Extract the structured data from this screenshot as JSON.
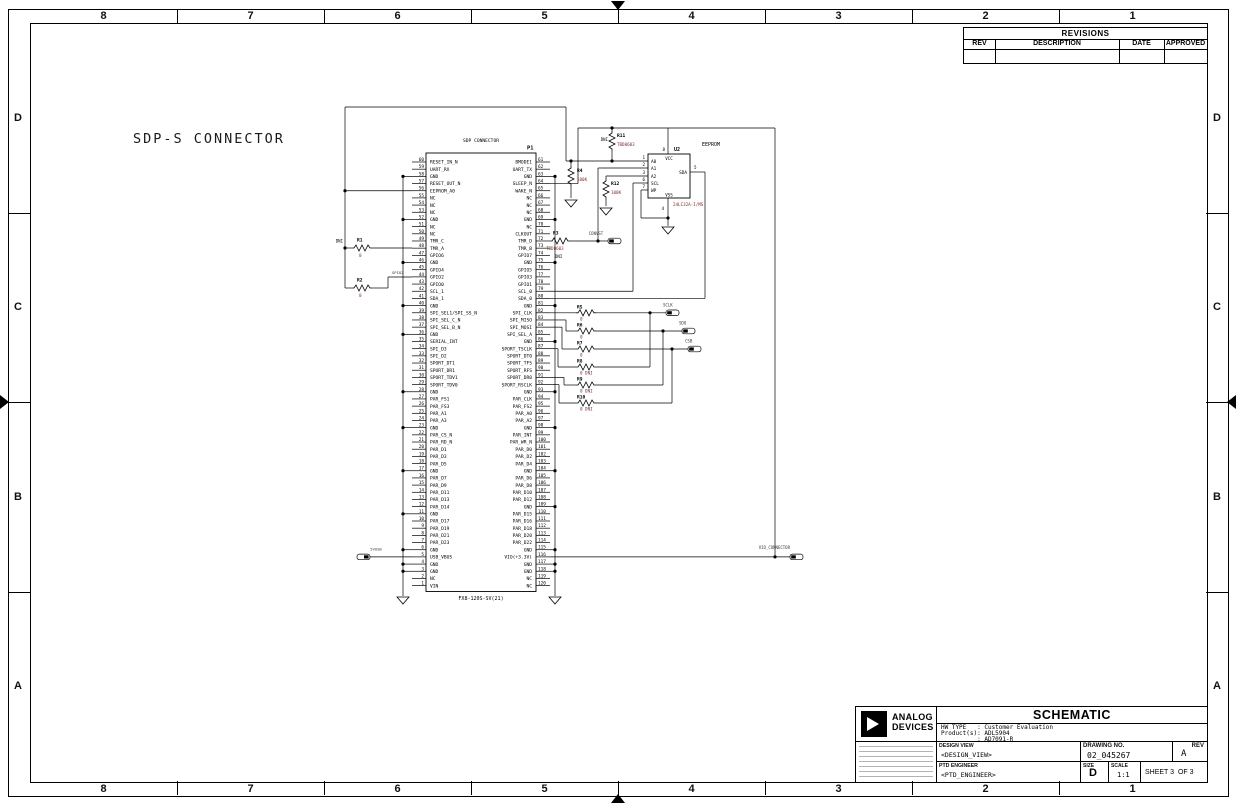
{
  "frame": {
    "columns": [
      "8",
      "7",
      "6",
      "5",
      "4",
      "3",
      "2",
      "1"
    ],
    "rows": [
      "D",
      "C",
      "B",
      "A"
    ]
  },
  "heading": "SDP-S CONNECTOR",
  "revisions": {
    "title": "REVISIONS",
    "headers": [
      "REV",
      "DESCRIPTION",
      "DATE",
      "APPROVED"
    ]
  },
  "connector": {
    "title": "SDP CONNECTOR",
    "refdes": "P1",
    "part": "FX8-120S-SV(21)",
    "left_pins": [
      [
        60,
        "RESET_IN_N"
      ],
      [
        59,
        "UART_RX"
      ],
      [
        58,
        "GND"
      ],
      [
        57,
        "RESET_OUT_N"
      ],
      [
        56,
        "EEPROM_A0"
      ],
      [
        55,
        "NC"
      ],
      [
        54,
        "NC"
      ],
      [
        53,
        "NC"
      ],
      [
        52,
        "GND"
      ],
      [
        51,
        "NC"
      ],
      [
        50,
        "NC"
      ],
      [
        49,
        "TMR_C"
      ],
      [
        48,
        "TMR_A"
      ],
      [
        47,
        "GPIO6"
      ],
      [
        46,
        "GND"
      ],
      [
        45,
        "GPIO4"
      ],
      [
        44,
        "GPIO2"
      ],
      [
        43,
        "GPIO0"
      ],
      [
        42,
        "SCL_1"
      ],
      [
        41,
        "SDA_1"
      ],
      [
        40,
        "GND"
      ],
      [
        39,
        "SPI_SEL1/SPI_SS_N"
      ],
      [
        38,
        "SPI_SEL_C_N"
      ],
      [
        37,
        "SPI_SEL_B_N"
      ],
      [
        36,
        "GND"
      ],
      [
        35,
        "SERIAL_INT"
      ],
      [
        34,
        "SPI_D3"
      ],
      [
        33,
        "SPI_D2"
      ],
      [
        32,
        "SPORT_DT1"
      ],
      [
        31,
        "SPORT_DR1"
      ],
      [
        30,
        "SPORT_TDV1"
      ],
      [
        29,
        "SPORT_TDV0"
      ],
      [
        28,
        "GND"
      ],
      [
        27,
        "PAR_FS1"
      ],
      [
        26,
        "PAR_FS3"
      ],
      [
        25,
        "PAR_A1"
      ],
      [
        24,
        "PAR_A3"
      ],
      [
        23,
        "GND"
      ],
      [
        22,
        "PAR_CS_N"
      ],
      [
        21,
        "PAR_RD_N"
      ],
      [
        20,
        "PAR_D1"
      ],
      [
        19,
        "PAR_D3"
      ],
      [
        18,
        "PAR_D5"
      ],
      [
        17,
        "GND"
      ],
      [
        16,
        "PAR_D7"
      ],
      [
        15,
        "PAR_D9"
      ],
      [
        14,
        "PAR_D11"
      ],
      [
        13,
        "PAR_D13"
      ],
      [
        12,
        "PAR_D14"
      ],
      [
        11,
        "GND"
      ],
      [
        10,
        "PAR_D17"
      ],
      [
        9,
        "PAR_D19"
      ],
      [
        8,
        "PAR_D21"
      ],
      [
        7,
        "PAR_D23"
      ],
      [
        6,
        "GND"
      ],
      [
        5,
        "USB_VBUS"
      ],
      [
        4,
        "GND"
      ],
      [
        3,
        "GND"
      ],
      [
        2,
        "NC"
      ],
      [
        1,
        "VIN"
      ]
    ],
    "right_pins": [
      [
        61,
        "BMODE1"
      ],
      [
        62,
        "UART_TX"
      ],
      [
        63,
        "GND"
      ],
      [
        64,
        "SLEEP_N"
      ],
      [
        65,
        "WAKE_N"
      ],
      [
        66,
        "NC"
      ],
      [
        67,
        "NC"
      ],
      [
        68,
        "NC"
      ],
      [
        69,
        "GND"
      ],
      [
        70,
        "NC"
      ],
      [
        71,
        "CLKOUT"
      ],
      [
        72,
        "TMR_D"
      ],
      [
        73,
        "TMR_B"
      ],
      [
        74,
        "GPIO7"
      ],
      [
        75,
        "GND"
      ],
      [
        76,
        "GPIO5"
      ],
      [
        77,
        "GPIO3"
      ],
      [
        78,
        "GPIO1"
      ],
      [
        79,
        "SCL_0"
      ],
      [
        80,
        "SDA_0"
      ],
      [
        81,
        "GND"
      ],
      [
        82,
        "SPI_CLK"
      ],
      [
        83,
        "SPI_MISO"
      ],
      [
        84,
        "SPI_MOSI"
      ],
      [
        85,
        "SPI_SEL_A"
      ],
      [
        86,
        "GND"
      ],
      [
        87,
        "SPORT_TSCLK"
      ],
      [
        88,
        "SPORT_DT0"
      ],
      [
        89,
        "SPORT_TFS"
      ],
      [
        90,
        "SPORT_RFS"
      ],
      [
        91,
        "SPORT_DR0"
      ],
      [
        92,
        "SPORT_RSCLK"
      ],
      [
        93,
        "GND"
      ],
      [
        94,
        "PAR_CLK"
      ],
      [
        95,
        "PAR_FS2"
      ],
      [
        96,
        "PAR_A0"
      ],
      [
        97,
        "PAR_A2"
      ],
      [
        98,
        "GND"
      ],
      [
        99,
        "PAR_INT"
      ],
      [
        100,
        "PAR_WR_N"
      ],
      [
        101,
        "PAR_D0"
      ],
      [
        102,
        "PAR_D2"
      ],
      [
        103,
        "PAR_D4"
      ],
      [
        104,
        "GND"
      ],
      [
        105,
        "PAR_D6"
      ],
      [
        106,
        "PAR_D8"
      ],
      [
        107,
        "PAR_D10"
      ],
      [
        108,
        "PAR_D12"
      ],
      [
        109,
        "GND"
      ],
      [
        110,
        "PAR_D15"
      ],
      [
        111,
        "PAR_D16"
      ],
      [
        112,
        "PAR_D18"
      ],
      [
        113,
        "PAR_D20"
      ],
      [
        114,
        "PAR_D22"
      ],
      [
        115,
        "GND"
      ],
      [
        116,
        "VIO(+3.3V)"
      ],
      [
        117,
        "GND"
      ],
      [
        118,
        "GND"
      ],
      [
        119,
        "NC"
      ],
      [
        120,
        "NC"
      ]
    ]
  },
  "eeprom": {
    "label": "EEPROM",
    "refdes": "U2",
    "part": "24LC32A-I/MS",
    "pins": {
      "a0": "A0",
      "a1": "A1",
      "a2": "A2",
      "scl": "SCL",
      "wp": "WP",
      "sda": "SDA",
      "vcc": "VCC",
      "vss": "VSS"
    },
    "pin_numbers": {
      "a0": "1",
      "a1": "2",
      "a2": "3",
      "scl": "6",
      "wp": "7",
      "sda": "5",
      "vcc": "8",
      "vss": "4"
    }
  },
  "resistors": {
    "R1": {
      "value": "0",
      "dni": "DNI"
    },
    "R2": {
      "value": "0",
      "dni": ""
    },
    "R3": {
      "value": "TBD0603",
      "dni": "DNI"
    },
    "R4": {
      "value": "100K",
      "dni": ""
    },
    "R5": {
      "value": "0",
      "dni": ""
    },
    "R6": {
      "value": "0",
      "dni": ""
    },
    "R7": {
      "value": "0",
      "dni": ""
    },
    "R8": {
      "value": "0 DNI",
      "dni": ""
    },
    "R9": {
      "value": "0 DNI",
      "dni": ""
    },
    "R10": {
      "value": "0 DNI",
      "dni": ""
    },
    "R11": {
      "value": "TBD0603",
      "dni": "DNI"
    },
    "R12": {
      "value": "100K",
      "dni": ""
    }
  },
  "net_labels": {
    "convst": "CONVST",
    "sclk": "SCLK",
    "sdo": "SDO",
    "csb": "CSB",
    "vbus": "5VUSB",
    "vio": "VIO_CONNECTOR",
    "gpio2": "GPIO2"
  },
  "title_block": {
    "schematic": "SCHEMATIC",
    "info_lines": "HW TYPE   : Customer Evaluation\nProduct(s): ADL5904\n          : AD7091-R",
    "design_view_label": "DESIGN VIEW",
    "design_view_value": "<DESIGN_VIEW>",
    "ptd_label": "PTD ENGINEER",
    "ptd_value": "<PTD_ENGINEER>",
    "drawing_no_label": "DRAWING NO.",
    "drawing_no_value": "02_045267",
    "rev_label": "REV",
    "rev_value": "A",
    "size_label": "SIZE",
    "size_value": "D",
    "scale_label": "SCALE",
    "scale_value": "1:1",
    "sheet_text": "SHEET 3  OF 3",
    "logo_line1": "ANALOG",
    "logo_line2": "DEVICES"
  },
  "colors": {
    "wire": "#000000",
    "value_text": "#7a2e2e",
    "net_text": "#3a3a3a"
  }
}
